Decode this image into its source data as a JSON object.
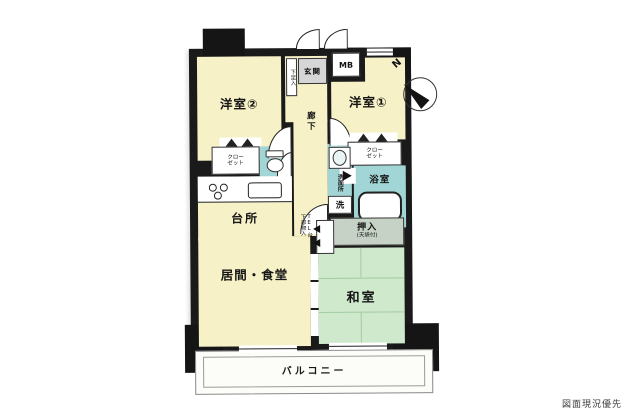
{
  "note": "図面現況優先",
  "compass": {
    "north": "N"
  },
  "colors": {
    "wall": "#1a1a1a",
    "room_cream": "#f6f1c6",
    "wet_teal": "#a2d5d5",
    "tatami_green": "#cfe9cc",
    "oshiire_green": "#c6d2c6",
    "entrance_gray": "#d6d6d6",
    "balcony_outline": "#8a8a8a"
  },
  "rooms": {
    "western2": {
      "label": "洋室②"
    },
    "western1": {
      "label": "洋室①"
    },
    "entrance": {
      "label": "玄関"
    },
    "shoe_cabinet": {
      "label": "下足入"
    },
    "meter_box": {
      "label": "MB"
    },
    "hallway": {
      "label": "廊下"
    },
    "closet_west2": {
      "label": "クローゼット"
    },
    "closet_west1": {
      "label": "クローゼット"
    },
    "washroom": {
      "label": "洗面所"
    },
    "washer_space": {
      "label": "洗"
    },
    "bathroom": {
      "label": "浴室"
    },
    "kitchen": {
      "label": "台所"
    },
    "tel_stand": {
      "label": "TEL台",
      "sub_label": "下部物入"
    },
    "oshiire": {
      "label": "押入",
      "sub_label": "(天袋付)"
    },
    "living_dining": {
      "label": "居間・食堂"
    },
    "japanese_room": {
      "label": "和室"
    },
    "balcony": {
      "label": "バルコニー"
    }
  }
}
